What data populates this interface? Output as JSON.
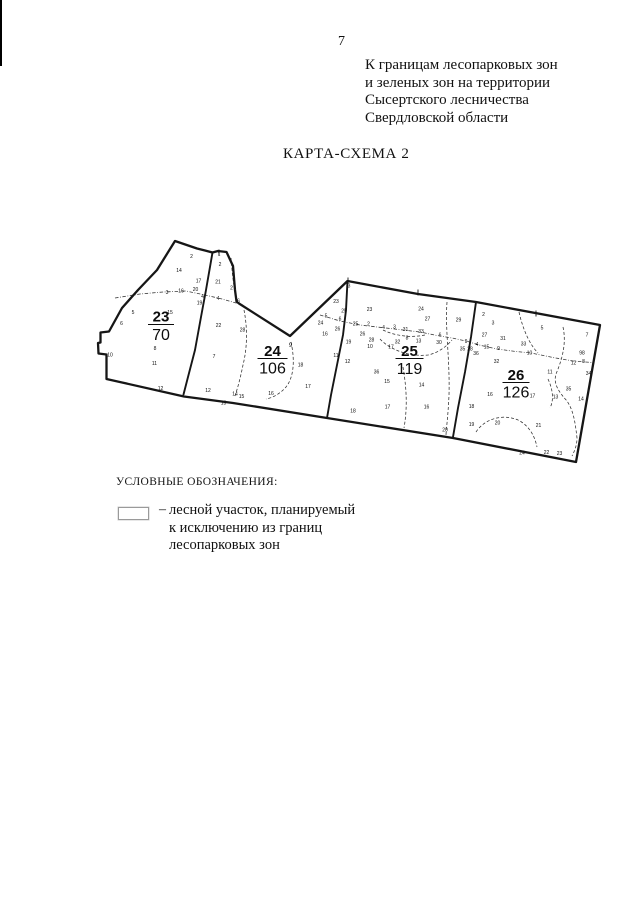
{
  "page": {
    "number": "7"
  },
  "header": {
    "note_lines": [
      "К границам лесопарковых зон",
      "и зеленых зон на территории",
      "Сысертского лесничества",
      "Свердловской области"
    ]
  },
  "title": "КАРТА-СХЕМА 2",
  "legend": {
    "heading": "УСЛОВНЫЕ ОБОЗНАЧЕНИЯ:",
    "dash": "–",
    "symbol": "white-rectangle-outline",
    "text_lines": [
      "лесной участок, планируемый",
      "к исключению из границ",
      "лесопарковых зон"
    ]
  },
  "map": {
    "ink": "#161616",
    "outline": [
      [
        175,
        241
      ],
      [
        197,
        248.5
      ],
      [
        205,
        250.5
      ],
      [
        212.5,
        252.5
      ],
      [
        218,
        251
      ],
      [
        226.5,
        252
      ],
      [
        233,
        266
      ],
      [
        235,
        290
      ],
      [
        236.5,
        301.5
      ],
      [
        239,
        303.5
      ],
      [
        290,
        336
      ],
      [
        347.5,
        281
      ],
      [
        418,
        294
      ],
      [
        476,
        302
      ],
      [
        600,
        325
      ],
      [
        576,
        462
      ],
      [
        453,
        438
      ],
      [
        327,
        418
      ],
      [
        233,
        403
      ],
      [
        184,
        396.5
      ],
      [
        106.5,
        379
      ],
      [
        106.5,
        354.5
      ],
      [
        98.5,
        353.5
      ],
      [
        98,
        343
      ],
      [
        100.5,
        342.5
      ],
      [
        100.5,
        332.5
      ],
      [
        109,
        331.5
      ],
      [
        122,
        308
      ],
      [
        138,
        290
      ],
      [
        157,
        270
      ]
    ],
    "boundaries": [
      [
        [
          212.5,
          252.5
        ],
        [
          206,
          290
        ],
        [
          201,
          317
        ],
        [
          195,
          350
        ],
        [
          188,
          377
        ],
        [
          183.5,
          394.5
        ]
      ],
      [
        [
          347.5,
          281
        ],
        [
          346,
          310
        ],
        [
          343,
          335
        ],
        [
          337,
          365
        ],
        [
          331,
          395
        ],
        [
          327,
          418
        ]
      ],
      [
        [
          476,
          302
        ],
        [
          471,
          337
        ],
        [
          465,
          372
        ],
        [
          458,
          408
        ],
        [
          453,
          437
        ]
      ]
    ],
    "dashdot": [
      [
        [
          115,
          298
        ],
        [
          140,
          294
        ],
        [
          163,
          292
        ],
        [
          186,
          291
        ],
        [
          205,
          295
        ],
        [
          222,
          299
        ],
        [
          243,
          305
        ]
      ],
      [
        [
          320,
          315
        ],
        [
          340,
          321
        ],
        [
          360,
          325
        ],
        [
          390,
          328.5
        ],
        [
          420,
          332
        ],
        [
          437,
          335.5
        ],
        [
          452,
          338
        ],
        [
          466,
          341
        ],
        [
          481,
          345.5
        ],
        [
          497,
          349
        ],
        [
          516,
          351.5
        ],
        [
          531,
          353
        ],
        [
          553,
          357.5
        ],
        [
          573,
          361
        ],
        [
          592,
          362.5
        ]
      ]
    ],
    "dashed": [
      "M231,258 C232,270 233,283 236,297",
      "M244,310 C247,325 248,345 243,365 C240,380 237,390 235,396",
      "M291,342 C295,360 294,377 286,387 C280,394 272,398 266,399",
      "M447,302 C445,330 450,360 449,395 C448,418 446,430 446,436",
      "M403,367 C406,385 408,405 404,428",
      "M380,339 C390,350 410,357 428,355 C438,353 447,346 452,340",
      "M383,330 C395,336 412,338 425,335",
      "M519,312 C523,330 530,345 538,353",
      "M563,327 C567,345 561,362 556,374 C553,384 559,392 567,401 C573,410 575,420 577,438 C577,446 574,452 572,456",
      "M476,432 C485,418 505,413 520,421 C530,427 535,437 537,447",
      "M548,379 C553,390 554,400 550,408"
    ],
    "ticks": [
      [
        219,
        249.5,
        255
      ],
      [
        348,
        277.5,
        283.5
      ],
      [
        418,
        289.5,
        295.5
      ],
      [
        536,
        310.5,
        316.5
      ]
    ],
    "quarters": [
      {
        "label": "23",
        "area": "70",
        "cx": 161,
        "num_y": 321.5,
        "bar_y": 324.5,
        "bar_w": 26,
        "den_y": 340
      },
      {
        "label": "24",
        "area": "106",
        "cx": 272.5,
        "num_y": 356,
        "bar_y": 358.5,
        "bar_w": 30,
        "den_y": 373.5
      },
      {
        "label": "25",
        "area": "119",
        "cx": 409.5,
        "num_y": 356,
        "bar_y": 358.5,
        "bar_w": 28,
        "den_y": 374
      },
      {
        "label": "26",
        "area": "126",
        "cx": 516,
        "num_y": 380,
        "bar_y": 382.5,
        "bar_w": 27,
        "den_y": 397.5
      }
    ],
    "numbers": [
      {
        "t": "2",
        "x": 191.5,
        "y": 256
      },
      {
        "t": "14",
        "x": 179,
        "y": 270
      },
      {
        "t": "17",
        "x": 198.5,
        "y": 280.5
      },
      {
        "t": "3",
        "x": 167,
        "y": 292
      },
      {
        "t": "16",
        "x": 181,
        "y": 290.5
      },
      {
        "t": "20",
        "x": 195.5,
        "y": 289
      },
      {
        "t": "15",
        "x": 170,
        "y": 312
      },
      {
        "t": "5",
        "x": 133,
        "y": 312
      },
      {
        "t": "6",
        "x": 121.5,
        "y": 323
      },
      {
        "t": "8",
        "x": 155,
        "y": 348
      },
      {
        "t": "10",
        "x": 110,
        "y": 354.5
      },
      {
        "t": "11",
        "x": 154.5,
        "y": 363
      },
      {
        "t": "12",
        "x": 160.5,
        "y": 388
      },
      {
        "t": "1",
        "x": 219,
        "y": 254
      },
      {
        "t": "2",
        "x": 220,
        "y": 264
      },
      {
        "t": "21",
        "x": 218,
        "y": 281.5
      },
      {
        "t": "2",
        "x": 231.5,
        "y": 287.5
      },
      {
        "t": "4",
        "x": 202.5,
        "y": 296
      },
      {
        "t": "19",
        "x": 199.5,
        "y": 302.5
      },
      {
        "t": "4",
        "x": 218,
        "y": 298
      },
      {
        "t": "6",
        "x": 238.5,
        "y": 300.5
      },
      {
        "t": "22",
        "x": 218.5,
        "y": 325
      },
      {
        "t": "28",
        "x": 242.5,
        "y": 329.5
      },
      {
        "t": "7",
        "x": 214,
        "y": 356
      },
      {
        "t": "12",
        "x": 208,
        "y": 390
      },
      {
        "t": "13",
        "x": 223.5,
        "y": 402.5
      },
      {
        "t": "14",
        "x": 235,
        "y": 393.5
      },
      {
        "t": "15",
        "x": 241.5,
        "y": 396
      },
      {
        "t": "9",
        "x": 290.5,
        "y": 345,
        "s": 6
      },
      {
        "t": "18",
        "x": 300.5,
        "y": 364.5
      },
      {
        "t": "16",
        "x": 271,
        "y": 393
      },
      {
        "t": "17",
        "x": 308,
        "y": 386
      },
      {
        "t": "3",
        "x": 349,
        "y": 285.5
      },
      {
        "t": "23",
        "x": 336,
        "y": 301
      },
      {
        "t": "5",
        "x": 326,
        "y": 315.5
      },
      {
        "t": "24",
        "x": 320.5,
        "y": 322.5
      },
      {
        "t": "6",
        "x": 340,
        "y": 318.5
      },
      {
        "t": "26",
        "x": 337.5,
        "y": 328.5
      },
      {
        "t": "16",
        "x": 325,
        "y": 333.5
      },
      {
        "t": "25",
        "x": 344,
        "y": 310.5
      },
      {
        "t": "19",
        "x": 348.5,
        "y": 341.5
      },
      {
        "t": "11",
        "x": 336,
        "y": 355
      },
      {
        "t": "12",
        "x": 347.5,
        "y": 361
      },
      {
        "t": "25",
        "x": 355.5,
        "y": 323.5
      },
      {
        "t": "2",
        "x": 368.5,
        "y": 323.5
      },
      {
        "t": "23",
        "x": 369.5,
        "y": 309
      },
      {
        "t": "24",
        "x": 421,
        "y": 308.5
      },
      {
        "t": "27",
        "x": 427.5,
        "y": 318.5
      },
      {
        "t": "29",
        "x": 458.5,
        "y": 319.5
      },
      {
        "t": "4",
        "x": 383.5,
        "y": 327
      },
      {
        "t": "3",
        "x": 394.5,
        "y": 326.5
      },
      {
        "t": "31",
        "x": 405.5,
        "y": 329
      },
      {
        "t": "33",
        "x": 421,
        "y": 331
      },
      {
        "t": "26",
        "x": 362.5,
        "y": 333.5
      },
      {
        "t": "28",
        "x": 371.5,
        "y": 339.5
      },
      {
        "t": "10",
        "x": 370,
        "y": 346
      },
      {
        "t": "17",
        "x": 391,
        "y": 346.5
      },
      {
        "t": "32",
        "x": 397.5,
        "y": 341.5
      },
      {
        "t": "8",
        "x": 407,
        "y": 337.5
      },
      {
        "t": "13",
        "x": 418.5,
        "y": 340.5
      },
      {
        "t": "6",
        "x": 440,
        "y": 334.5
      },
      {
        "t": "30",
        "x": 439,
        "y": 342
      },
      {
        "t": "9",
        "x": 466,
        "y": 341
      },
      {
        "t": "35",
        "x": 462.5,
        "y": 348.5
      },
      {
        "t": "36",
        "x": 376.5,
        "y": 371.5
      },
      {
        "t": "15",
        "x": 387,
        "y": 381
      },
      {
        "t": "14",
        "x": 421.5,
        "y": 384.5
      },
      {
        "t": "17",
        "x": 387.5,
        "y": 406.5
      },
      {
        "t": "16",
        "x": 426.5,
        "y": 406.5
      },
      {
        "t": "18",
        "x": 353,
        "y": 410.5
      },
      {
        "t": "20",
        "x": 445,
        "y": 429.5
      },
      {
        "t": "2",
        "x": 483.5,
        "y": 314
      },
      {
        "t": "3",
        "x": 493,
        "y": 322.5
      },
      {
        "t": "27",
        "x": 484.5,
        "y": 334.5
      },
      {
        "t": "31",
        "x": 503,
        "y": 338
      },
      {
        "t": "5",
        "x": 542,
        "y": 327.5
      },
      {
        "t": "7",
        "x": 587,
        "y": 334.5
      },
      {
        "t": "28",
        "x": 470,
        "y": 348.5
      },
      {
        "t": "4",
        "x": 477,
        "y": 344
      },
      {
        "t": "15",
        "x": 486.5,
        "y": 346.5
      },
      {
        "t": "9",
        "x": 498.5,
        "y": 348
      },
      {
        "t": "36",
        "x": 476,
        "y": 353
      },
      {
        "t": "33",
        "x": 523.5,
        "y": 343.5
      },
      {
        "t": "10",
        "x": 529.5,
        "y": 352.5
      },
      {
        "t": "32",
        "x": 496.5,
        "y": 361
      },
      {
        "t": "98",
        "x": 582,
        "y": 352.5
      },
      {
        "t": "8",
        "x": 583.5,
        "y": 361
      },
      {
        "t": "12",
        "x": 573.5,
        "y": 362.5
      },
      {
        "t": "11",
        "x": 550,
        "y": 371.5
      },
      {
        "t": "34",
        "x": 588.5,
        "y": 373
      },
      {
        "t": "17",
        "x": 532.5,
        "y": 395.5
      },
      {
        "t": "16",
        "x": 490,
        "y": 394
      },
      {
        "t": "35",
        "x": 568.5,
        "y": 388.5
      },
      {
        "t": "13",
        "x": 555.5,
        "y": 396.5
      },
      {
        "t": "14",
        "x": 581,
        "y": 398.5
      },
      {
        "t": "18",
        "x": 471.5,
        "y": 406
      },
      {
        "t": "19",
        "x": 471.5,
        "y": 424
      },
      {
        "t": "20",
        "x": 497.5,
        "y": 422.5
      },
      {
        "t": "21",
        "x": 538.5,
        "y": 425
      },
      {
        "t": "22",
        "x": 546.5,
        "y": 452
      },
      {
        "t": "23",
        "x": 559.5,
        "y": 453
      },
      {
        "t": "24",
        "x": 522,
        "y": 452.5
      }
    ]
  }
}
